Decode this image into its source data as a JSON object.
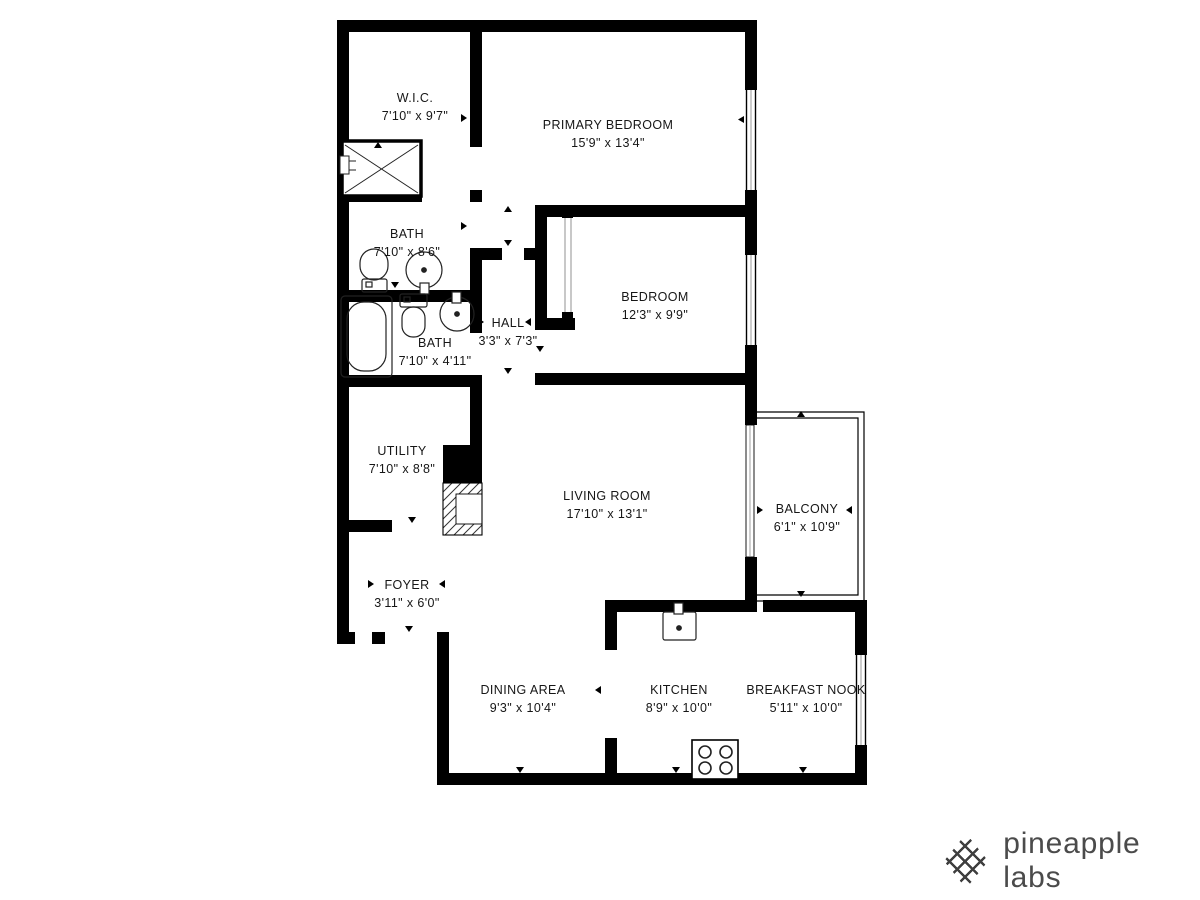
{
  "floorplan": {
    "colors": {
      "wall": "#000000",
      "label_text": "#161616",
      "fixture_line": "#222222"
    },
    "rooms": [
      {
        "name": "W.I.C.",
        "dims": "7'10\" x 9'7\""
      },
      {
        "name": "PRIMARY BEDROOM",
        "dims": "15'9\" x 13'4\""
      },
      {
        "name": "BATH",
        "dims": "7'10\" x 8'6\""
      },
      {
        "name": "BATH",
        "dims": "7'10\" x 4'11\""
      },
      {
        "name": "HALL",
        "dims": "3'3\" x 7'3\""
      },
      {
        "name": "BEDROOM",
        "dims": "12'3\" x 9'9\""
      },
      {
        "name": "UTILITY",
        "dims": "7'10\" x 8'8\""
      },
      {
        "name": "LIVING ROOM",
        "dims": "17'10\" x 13'1\""
      },
      {
        "name": "BALCONY",
        "dims": "6'1\" x 10'9\""
      },
      {
        "name": "FOYER",
        "dims": "3'11\" x 6'0\""
      },
      {
        "name": "DINING AREA",
        "dims": "9'3\" x 10'4\""
      },
      {
        "name": "KITCHEN",
        "dims": "8'9\" x 10'0\""
      },
      {
        "name": "BREAKFAST NOOK",
        "dims": "5'11\" x 10'0\""
      }
    ],
    "fixtures": [
      "shower-icon",
      "toilet-icon",
      "round-sink-icon",
      "bathtub-icon",
      "kitchen-sink-icon",
      "stove-4-burner-icon"
    ]
  },
  "branding": {
    "logo_icon": "pineapple-lattice-icon",
    "logo_text": "pineapple labs",
    "logo_color": "#4b4b4b"
  }
}
